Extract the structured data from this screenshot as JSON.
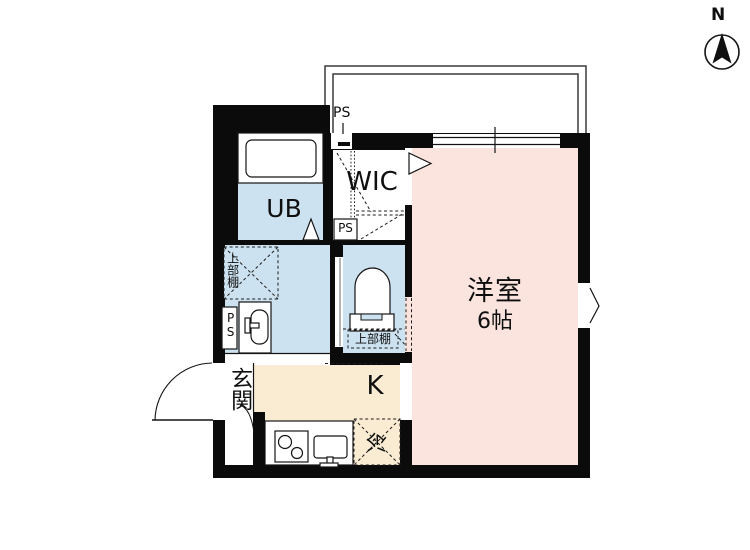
{
  "compass": {
    "north_label": "N"
  },
  "labels": {
    "ps_top": "PS",
    "ps_wic": "PS",
    "ps_left": "PS",
    "wic": "WIC",
    "unit_bath": "UB",
    "upper_shelf_washroom": "上部棚",
    "upper_shelf_toilet": "上部棚",
    "western_room_name": "洋室",
    "western_room_size": "6帖",
    "kitchen": "K",
    "entrance": "玄関",
    "refrigerator": "冷"
  },
  "colors": {
    "wall": "#0b0b0b",
    "western_room": "#fae4dd",
    "wet_area": "#cde2f0",
    "kitchen": "#faecd2"
  }
}
